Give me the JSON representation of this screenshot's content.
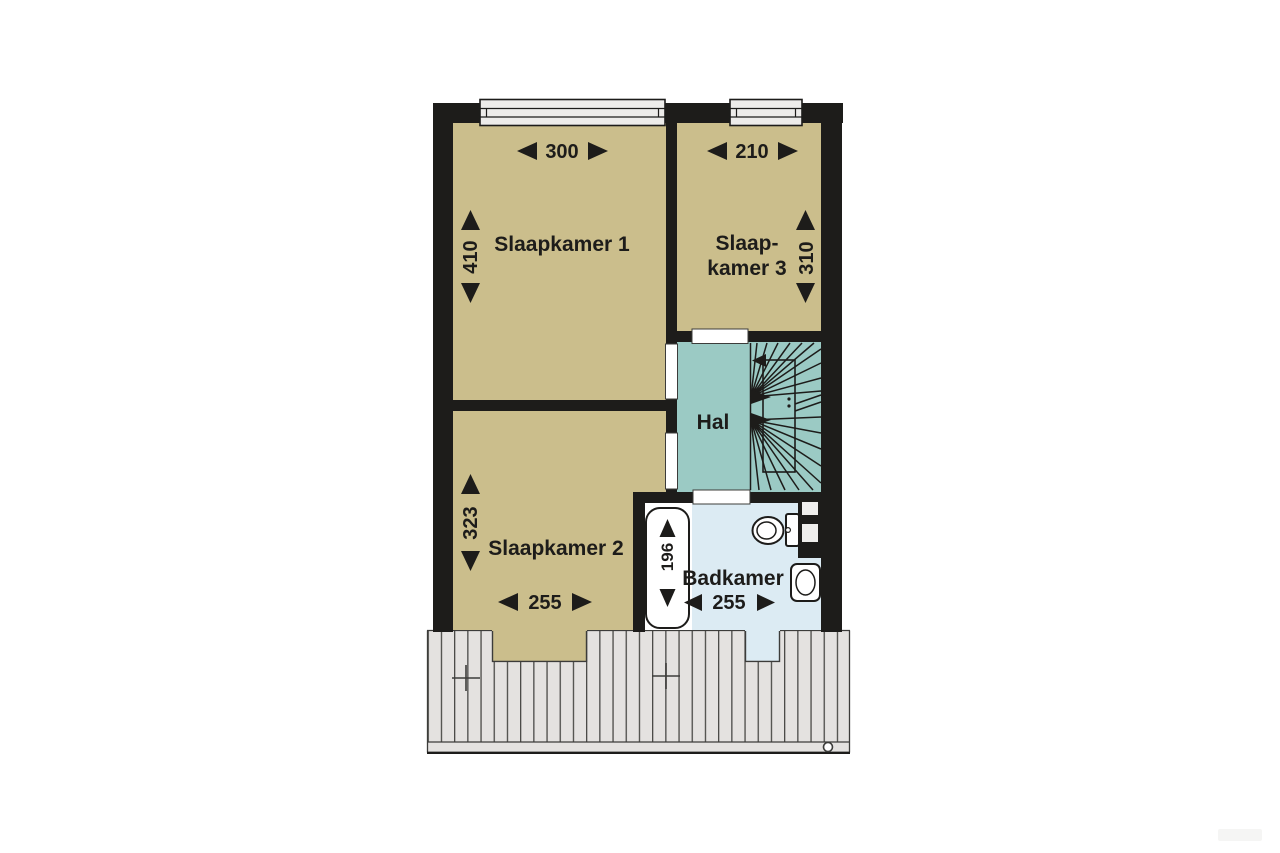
{
  "floorplan": {
    "type": "upper-floor plan (Dutch labels)",
    "rooms": [
      {
        "id": "slaapkamer-1",
        "name": "Slaapkamer 1",
        "width_cm": "300",
        "depth_cm": "410"
      },
      {
        "id": "slaapkamer-2",
        "name": "Slaapkamer 2",
        "width_cm": "255",
        "depth_cm": "323"
      },
      {
        "id": "slaapkamer-3",
        "name_line_1": "Slaap-",
        "name_line_2": "kamer 3",
        "width_cm": "210",
        "depth_cm": "310"
      },
      {
        "id": "hal",
        "name": "Hal"
      },
      {
        "id": "badkamer",
        "name": "Badkamer",
        "width_cm": "255",
        "bathtub_length_cm": "196"
      }
    ],
    "fixtures": [
      "staircase",
      "bathtub",
      "toilet",
      "sink",
      "roof-vent-crosses",
      "roof-drain"
    ],
    "colors": {
      "bedroom_fill": "#cbbe8c",
      "hall_fill": "#9bcac4",
      "bathroom_fill": "#dcebf3",
      "wall": "#1d1c1a",
      "roof_fill": "#e4e2e0",
      "roof_line": "#4a4a47",
      "window_fill": "#edecea",
      "background": "#ffffff"
    }
  }
}
